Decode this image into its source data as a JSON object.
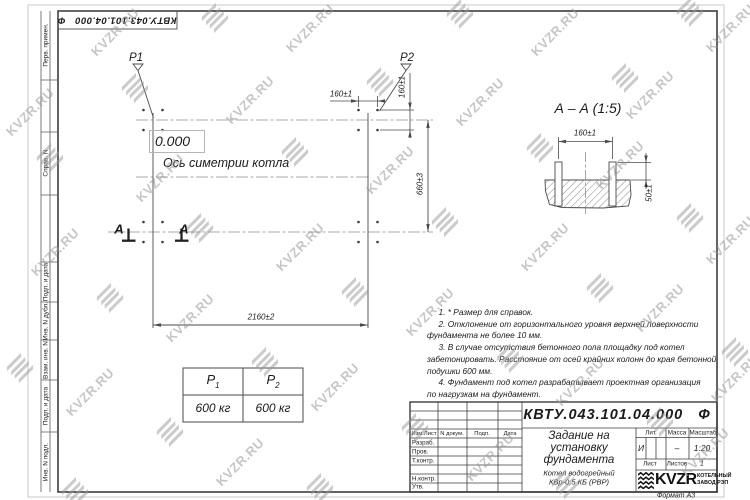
{
  "watermark": {
    "text": "KVZR.RU",
    "color": "#989898",
    "texts": [
      [
        115,
        32
      ],
      [
        310,
        28
      ],
      [
        555,
        32
      ],
      [
        730,
        28
      ],
      [
        30,
        112
      ],
      [
        250,
        100
      ],
      [
        480,
        102
      ],
      [
        650,
        95
      ],
      [
        160,
        178
      ],
      [
        390,
        170
      ],
      [
        620,
        165
      ],
      [
        55,
        252
      ],
      [
        300,
        247
      ],
      [
        545,
        247
      ],
      [
        730,
        240
      ],
      [
        190,
        318
      ],
      [
        430,
        312
      ],
      [
        660,
        308
      ],
      [
        90,
        392
      ],
      [
        335,
        387
      ],
      [
        580,
        382
      ],
      [
        735,
        378
      ],
      [
        240,
        462
      ],
      [
        490,
        457
      ],
      [
        705,
        452
      ]
    ],
    "icons": [
      [
        215,
        18
      ],
      [
        460,
        14
      ],
      [
        690,
        12
      ],
      [
        135,
        88
      ],
      [
        380,
        82
      ],
      [
        625,
        78
      ],
      [
        50,
        158
      ],
      [
        295,
        152
      ],
      [
        540,
        148
      ],
      [
        200,
        228
      ],
      [
        445,
        222
      ],
      [
        690,
        218
      ],
      [
        110,
        298
      ],
      [
        355,
        292
      ],
      [
        600,
        288
      ],
      [
        20,
        368
      ],
      [
        265,
        362
      ],
      [
        510,
        358
      ],
      [
        735,
        352
      ],
      [
        170,
        432
      ],
      [
        415,
        428
      ],
      [
        660,
        422
      ],
      [
        75,
        492
      ],
      [
        320,
        488
      ],
      [
        565,
        484
      ]
    ]
  },
  "stamp_top": "КВТУ.043.101.04.000   Ф",
  "margin_strip": {
    "labels": [
      "Перв. примен.",
      "Справ. N",
      "Подп. и дата",
      "Инв. N дубл.",
      "Взам. инв. N",
      "Подп. и дата",
      "Инв. N подл."
    ]
  },
  "plan": {
    "p1_label": "P1",
    "p2_label": "P2",
    "level_mark": "0.000",
    "axis_label": "Ось симетрии котла",
    "dim_width": "2160±2",
    "dim_depth": "660±3",
    "dim_bolt_h": "160±1",
    "dim_bolt_v": "160±1",
    "section_letter_left": "А",
    "section_letter_right": "А"
  },
  "section_view": {
    "title": "А – А (1:5)",
    "dim_spacing": "160±1",
    "dim_height": "50±1"
  },
  "load_table": {
    "col1": {
      "sym": "P",
      "sub": "1"
    },
    "col2": {
      "sym": "P",
      "sub": "2"
    },
    "val1": "600 кг",
    "val2": "600 кг"
  },
  "notes": {
    "lines": [
      "     1. * Размер для справок.",
      "     2. Отклонение от горизонтального уровня верхней поверхности",
      "фундамента не более 10 мм.",
      "     3. В случае отсутствия бетонного пола площадку под котел",
      "забетонировать. Расстояние от осей крайних колонн до края бетонной",
      "подушки 600 мм.",
      "     4. Фундамент под котел разрабатывает проектная организация",
      "по нагрузкам на фундамент."
    ]
  },
  "title_block": {
    "designation": "КВТУ.043.101.04.000   Ф",
    "doc_title_lines": [
      "Задание на",
      "установку",
      "фундамента"
    ],
    "product_lines": [
      "Котел водогрейный",
      "КВр-0,5 КБ (РВР)"
    ],
    "header_cols": [
      "Изм.Лист",
      "N докум.",
      "Подп.",
      "Дата"
    ],
    "row_labels": [
      "Разраб.",
      "Пров.",
      "Т.контр.",
      "Н.контр.",
      "Утв."
    ],
    "lit_label": "Лит.",
    "lit_value": "И",
    "mass_label": "Масса",
    "mass_value": "–",
    "scale_label": "Масштаб",
    "scale_value": "1:20",
    "sheet_label": "Лист",
    "sheets_label": "Листов",
    "sheets_value": "1",
    "company_name": "KVZR",
    "company_sub": [
      "КОТЕЛЬНЫЙ",
      "ЗАВОД РЭП"
    ],
    "format_label": "Формат А3"
  }
}
